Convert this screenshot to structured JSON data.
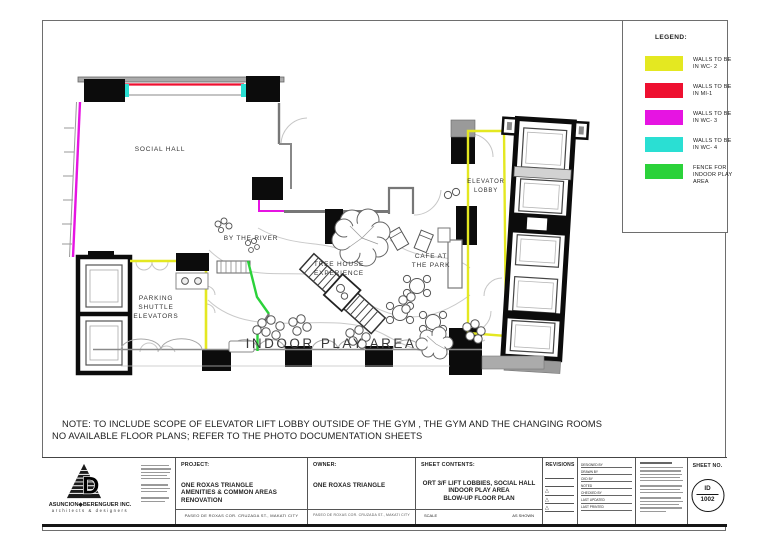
{
  "colors": {
    "wc2_yellow": "#e4e821",
    "mi1_red": "#ee1030",
    "wc3_magenta": "#e614e2",
    "wc4_cyan": "#2adfd3",
    "fence_green": "#2bd23a"
  },
  "legend": {
    "title": "LEGEND:",
    "items": [
      {
        "name": "wc2",
        "lines": [
          "WALLS TO BE",
          "IN WC- 2"
        ]
      },
      {
        "name": "mi1",
        "lines": [
          "WALLS TO BE",
          "IN MI-1"
        ]
      },
      {
        "name": "wc3",
        "lines": [
          "WALLS TO BE",
          "IN WC- 3"
        ]
      },
      {
        "name": "wc4",
        "lines": [
          "WALLS TO BE",
          "IN WC- 4"
        ]
      },
      {
        "name": "fence",
        "lines": [
          "FENCE FOR",
          "INDOOR PLAY",
          "AREA"
        ]
      }
    ]
  },
  "plan": {
    "labels": {
      "social_hall": "SOCIAL HALL",
      "by_the_river": "BY THE RIVER",
      "tree_house_1": "TREE HOUSE",
      "tree_house_2": "EXPERIENCE",
      "cafe_1": "CAFE AT",
      "cafe_2": "THE PARK",
      "indoor_play": "INDOOR PLAY AREA",
      "elevator_lobby_1": "ELEVATOR",
      "elevator_lobby_2": "LOBBY",
      "parking_1": "PARKING",
      "parking_2": "SHUTTLE",
      "parking_3": "ELEVATORS"
    }
  },
  "note": {
    "line1": "NOTE: TO INCLUDE SCOPE OF ELEVATOR LIFT LOBBY OUTSIDE OF THE GYM , THE GYM AND THE CHANGING ROOMS",
    "line2": "NO AVAILABLE FLOOR PLANS; REFER TO THE PHOTO DOCUMENTATION SHEETS"
  },
  "title_block": {
    "firm_name": "ASUNCION◆BERENGUER INC.",
    "firm_subtitle": "architects & designers",
    "project_label": "PROJECT:",
    "project_name_1": "ONE ROXAS TRIANGLE",
    "project_name_2": "AMENITIES & COMMON AREAS RENOVATION",
    "project_address": "PASEO DE ROXAS COR. CRUZADA ST., MAKATI CITY",
    "owner_label": "OWNER:",
    "owner_name": "ONE ROXAS TRIANGLE",
    "owner_address": "PASEO DE ROXAS COR. CRUZADA ST., MAKATI CITY",
    "sheet_contents_label": "SHEET CONTENTS:",
    "sheet_contents_1": "ORT 3/F LIFT LOBBIES, SOCIAL HALL",
    "sheet_contents_2": "INDOOR PLAY AREA",
    "sheet_contents_3": "BLOW-UP FLOOR PLAN",
    "scale_label": "SCALE",
    "scale_value": "AS SHOWN",
    "revisions_label": "REVISIONS",
    "revision_marker": "△",
    "fields": [
      "DESIGNED BY",
      "DRAWN BY",
      "CKD BY",
      "NOTED",
      "CHECKED BY",
      "LAST UPDATED",
      "LAST PRINTED"
    ],
    "sheet_no_label": "SHEET NO.",
    "sheet_no_top": "ID",
    "sheet_no_bottom": "1002"
  }
}
